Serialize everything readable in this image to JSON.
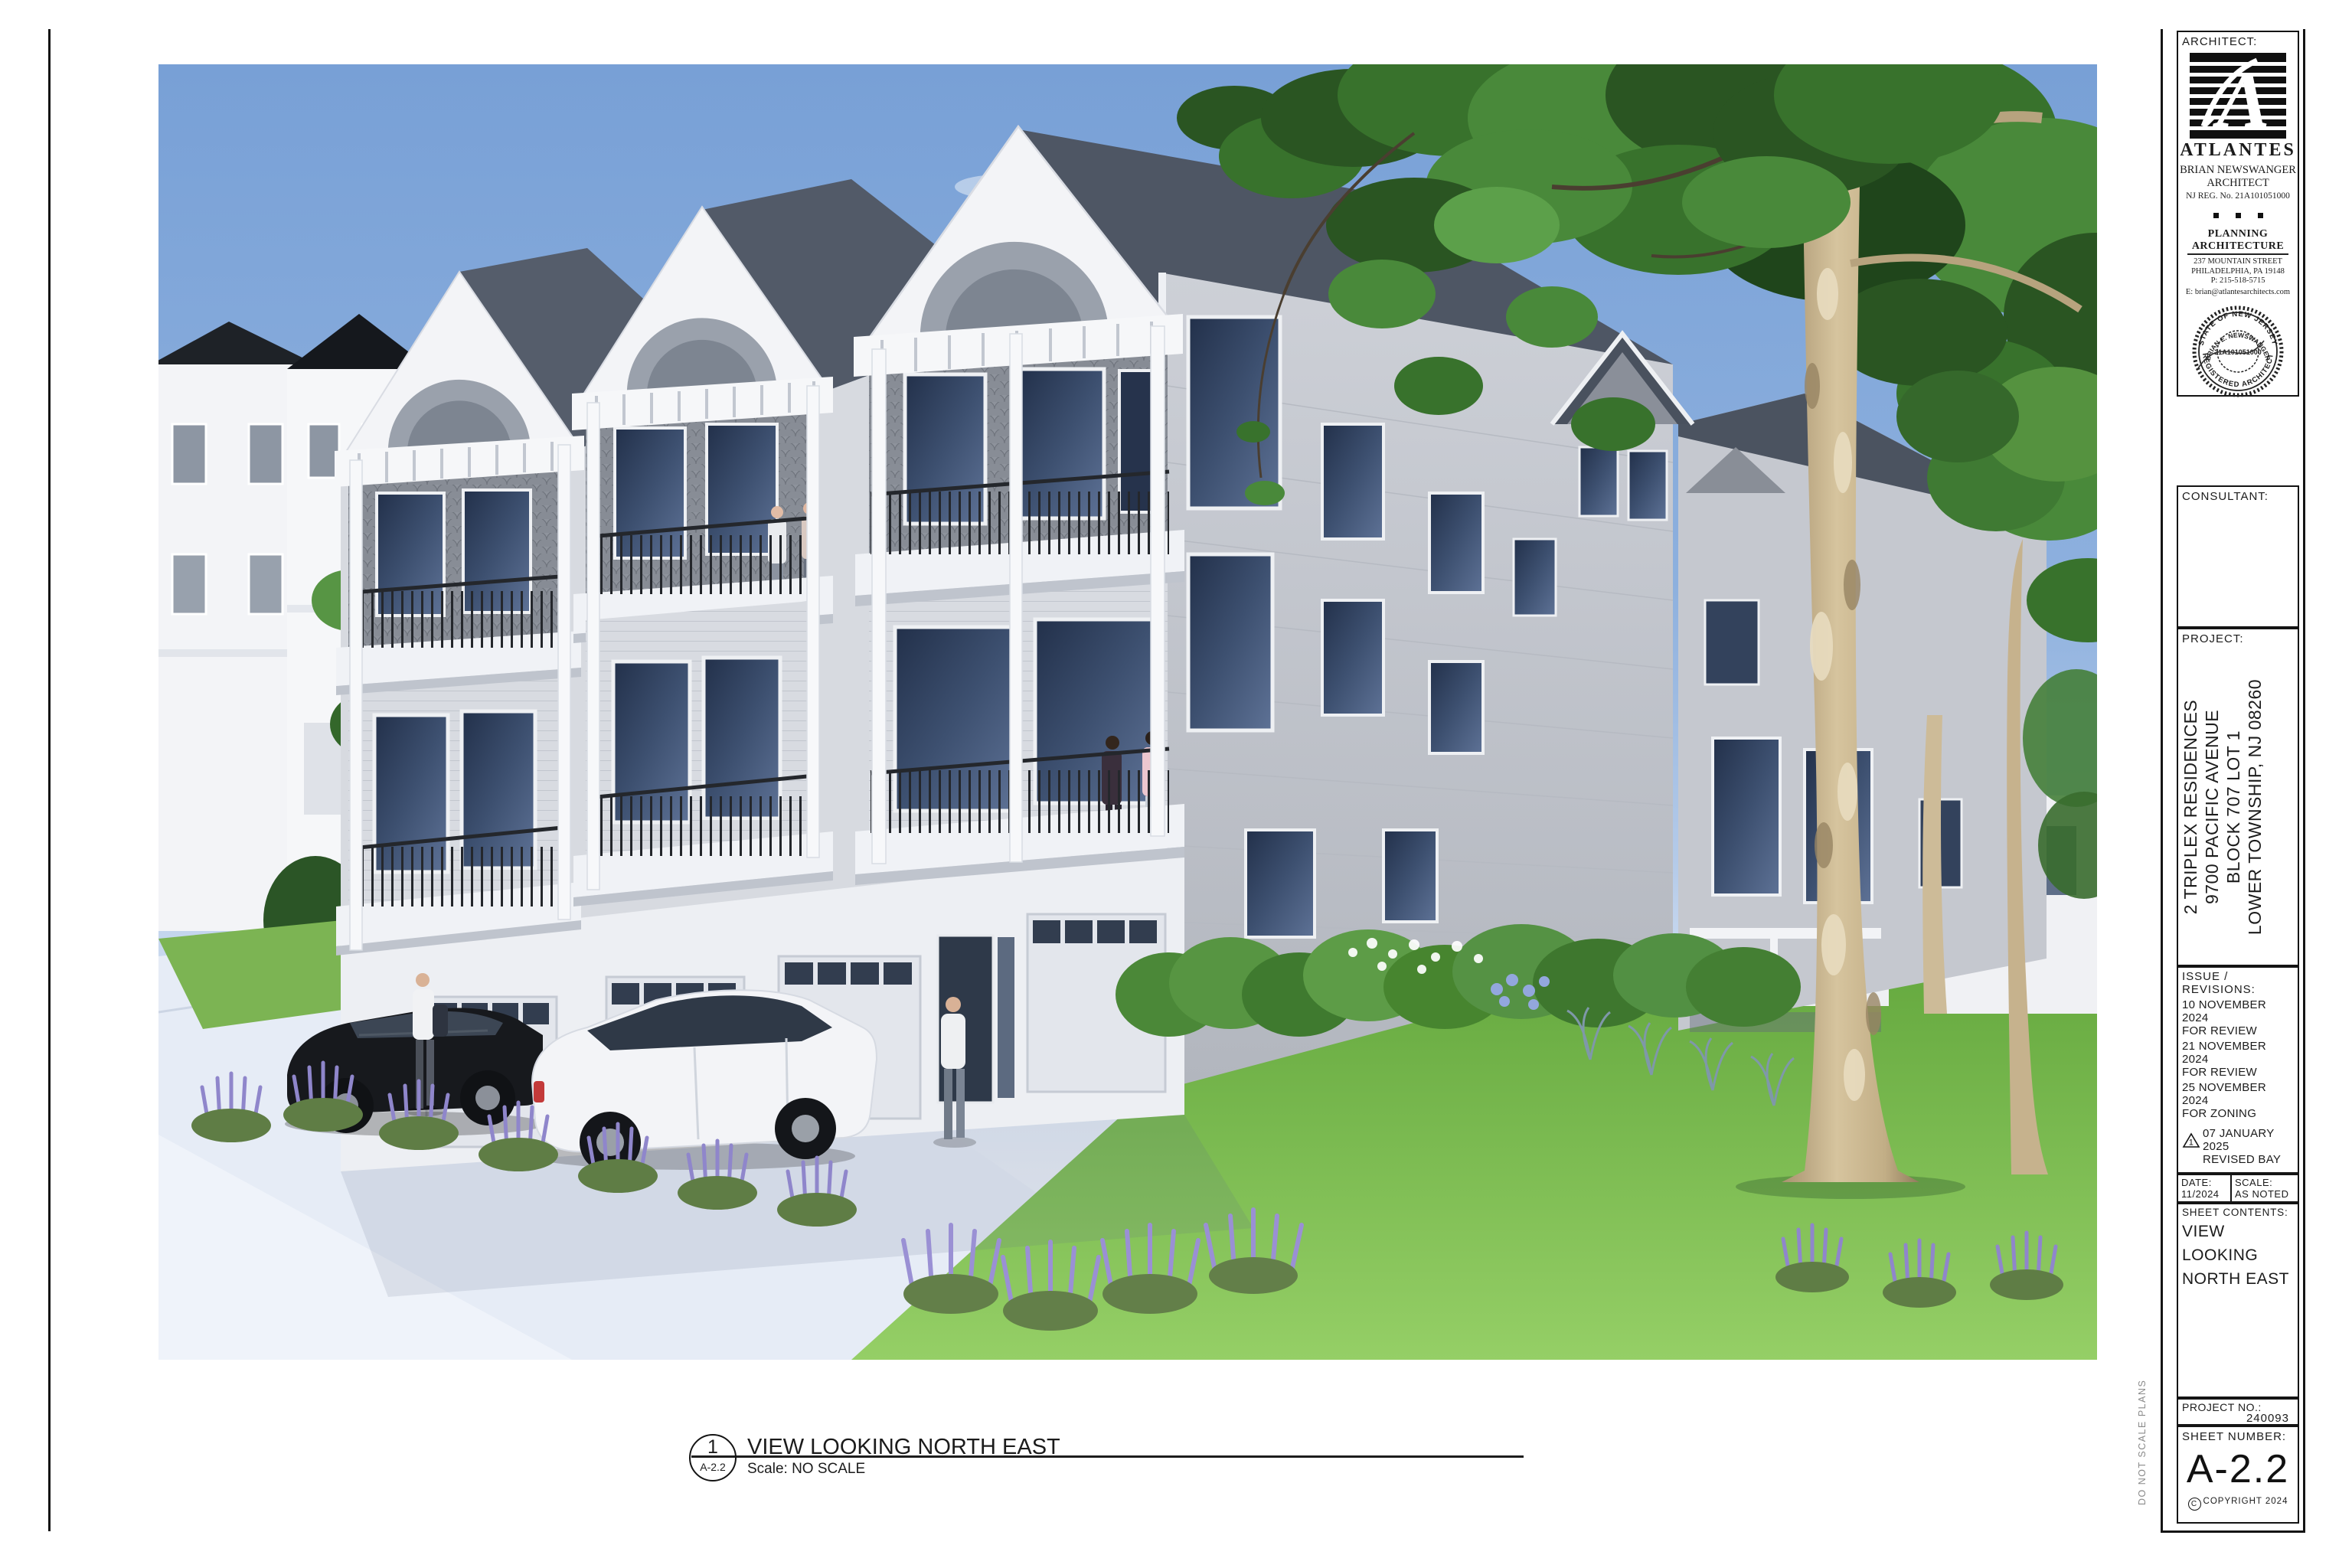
{
  "view": {
    "detail_number": "1",
    "detail_sheet_ref": "A-2.2",
    "title": "VIEW LOOKING NORTH EAST",
    "scale_note": "Scale: NO SCALE"
  },
  "margin_note": "DO NOT SCALE PLANS",
  "titleblock": {
    "architect": {
      "label": "ARCHITECT:",
      "logo_letter": "A",
      "firm_name": "ATLANTES",
      "person_line1": "BRIAN NEWSWANGER",
      "person_line2": "ARCHITECT",
      "registration": "NJ REG. No. 21A101051000",
      "practice_line1": "PLANNING",
      "practice_line2": "ARCHITECTURE",
      "address_line1": "237 MOUNTAIN STREET",
      "address_line2": "PHILADELPHIA, PA 19148",
      "phone": "P: 215-518-5715",
      "email": "E: brian@atlantesarchitects.com",
      "seal": {
        "arc_top": "STATE OF NEW JERSEY",
        "arc_name": "BRIAN E. NEWSWANGER",
        "license_number": "21A101051000",
        "arc_bottom": "REGISTERED ARCHITECT"
      }
    },
    "consultant_label": "CONSULTANT:",
    "project": {
      "label": "PROJECT:",
      "line1": "2 TRIPLEX RESIDENCES",
      "line2": "9700 PACIFIC AVENUE",
      "line3": "BLOCK 707 LOT 1",
      "line4": "LOWER TOWNSHIP, NJ 08260"
    },
    "revisions": {
      "label": "ISSUE / REVISIONS:",
      "items": [
        {
          "date": "10 NOVEMBER 2024",
          "note": "FOR REVIEW",
          "marker": ""
        },
        {
          "date": "21 NOVEMBER 2024",
          "note": "FOR REVIEW",
          "marker": ""
        },
        {
          "date": "25 NOVEMBER 2024",
          "note": "FOR ZONING",
          "marker": ""
        },
        {
          "date": "07 JANUARY 2025",
          "note": "REVISED BAY",
          "marker": "1"
        }
      ]
    },
    "date_label": "DATE:",
    "date_value": "11/2024",
    "scale_label": "SCALE:",
    "scale_value": "AS NOTED",
    "sheet_contents": {
      "label": "SHEET CONTENTS:",
      "line1": "VIEW",
      "line2": "LOOKING",
      "line3": "NORTH EAST"
    },
    "project_no_label": "PROJECT NO.:",
    "project_no_value": "240093",
    "sheet_number_label": "SHEET NUMBER:",
    "copyright": "COPYRIGHT 2024",
    "sheet_number_value": "A-2.2"
  },
  "colors": {
    "sky": "#78a0d6",
    "lawn": "#6fae46",
    "siding_light": "#d7dae0",
    "siding_side": "#c6c9d0",
    "shingle": "#8e939c",
    "trim_white": "#f3f4f7",
    "glass": "#31415c",
    "railing": "#24272c",
    "roof": "#4e5664",
    "pavement": "#e6ecf6",
    "tree_canopy": "#38722c",
    "tree_trunk": "#c9b48e",
    "lavender": "#8f86cb",
    "line_black": "#141414"
  }
}
